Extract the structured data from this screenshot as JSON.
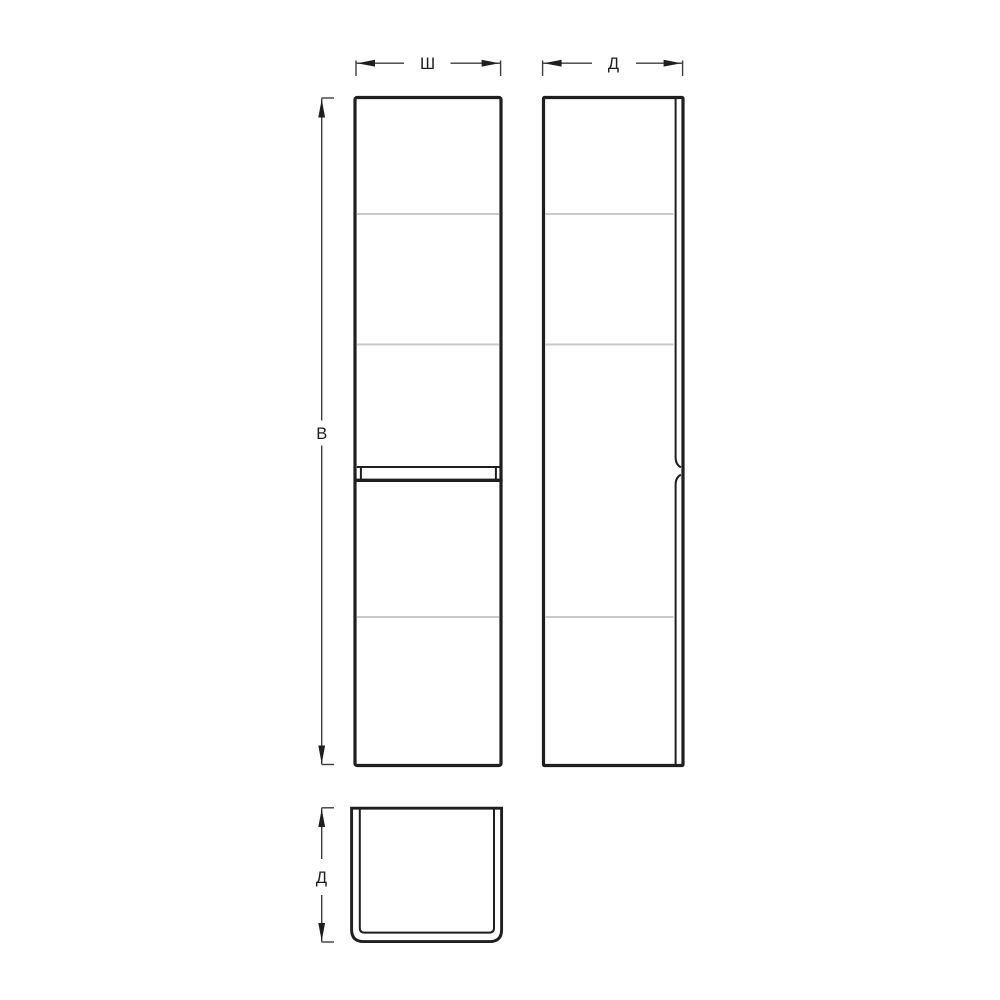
{
  "drawing": {
    "kind": "cabinet-orthographic-technical-drawing",
    "labels": {
      "width": "Ш",
      "depth_top": "Д",
      "height": "В",
      "depth_bottom": "Д"
    },
    "colors": {
      "background": "#ffffff",
      "outline": "#1f1f1f",
      "shelf_line": "#c9c9c9",
      "dimension_line": "#3d3d3d",
      "label_text": "#1f1f1f"
    }
  }
}
